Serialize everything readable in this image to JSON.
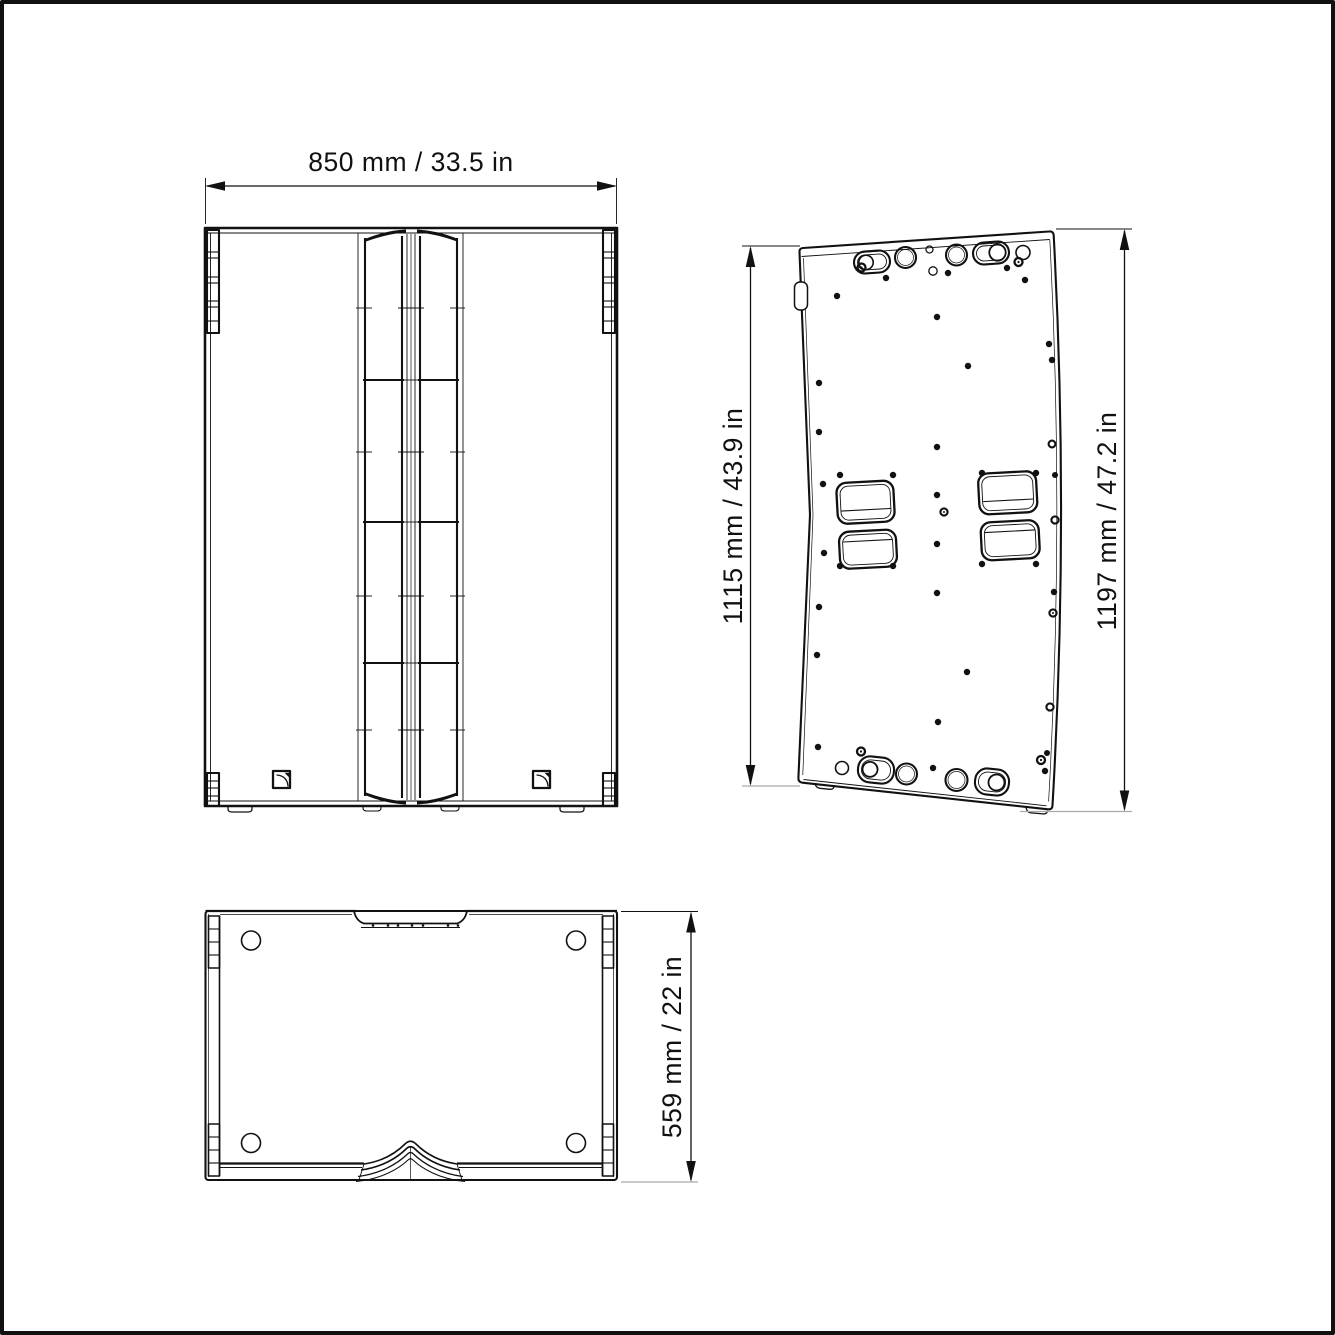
{
  "colors": {
    "background": "#ffffff",
    "line": "#111111",
    "frame": "#000000",
    "ground_line": "#aaaaaa"
  },
  "views": {
    "front": {
      "width_dimension": "850 mm / 33.5 in"
    },
    "rear": {
      "height_left_dimension": "1115 mm / 43.9 in",
      "height_right_dimension": "1197 mm / 47.2 in"
    },
    "top": {
      "depth_dimension": "559 mm / 22 in"
    }
  }
}
